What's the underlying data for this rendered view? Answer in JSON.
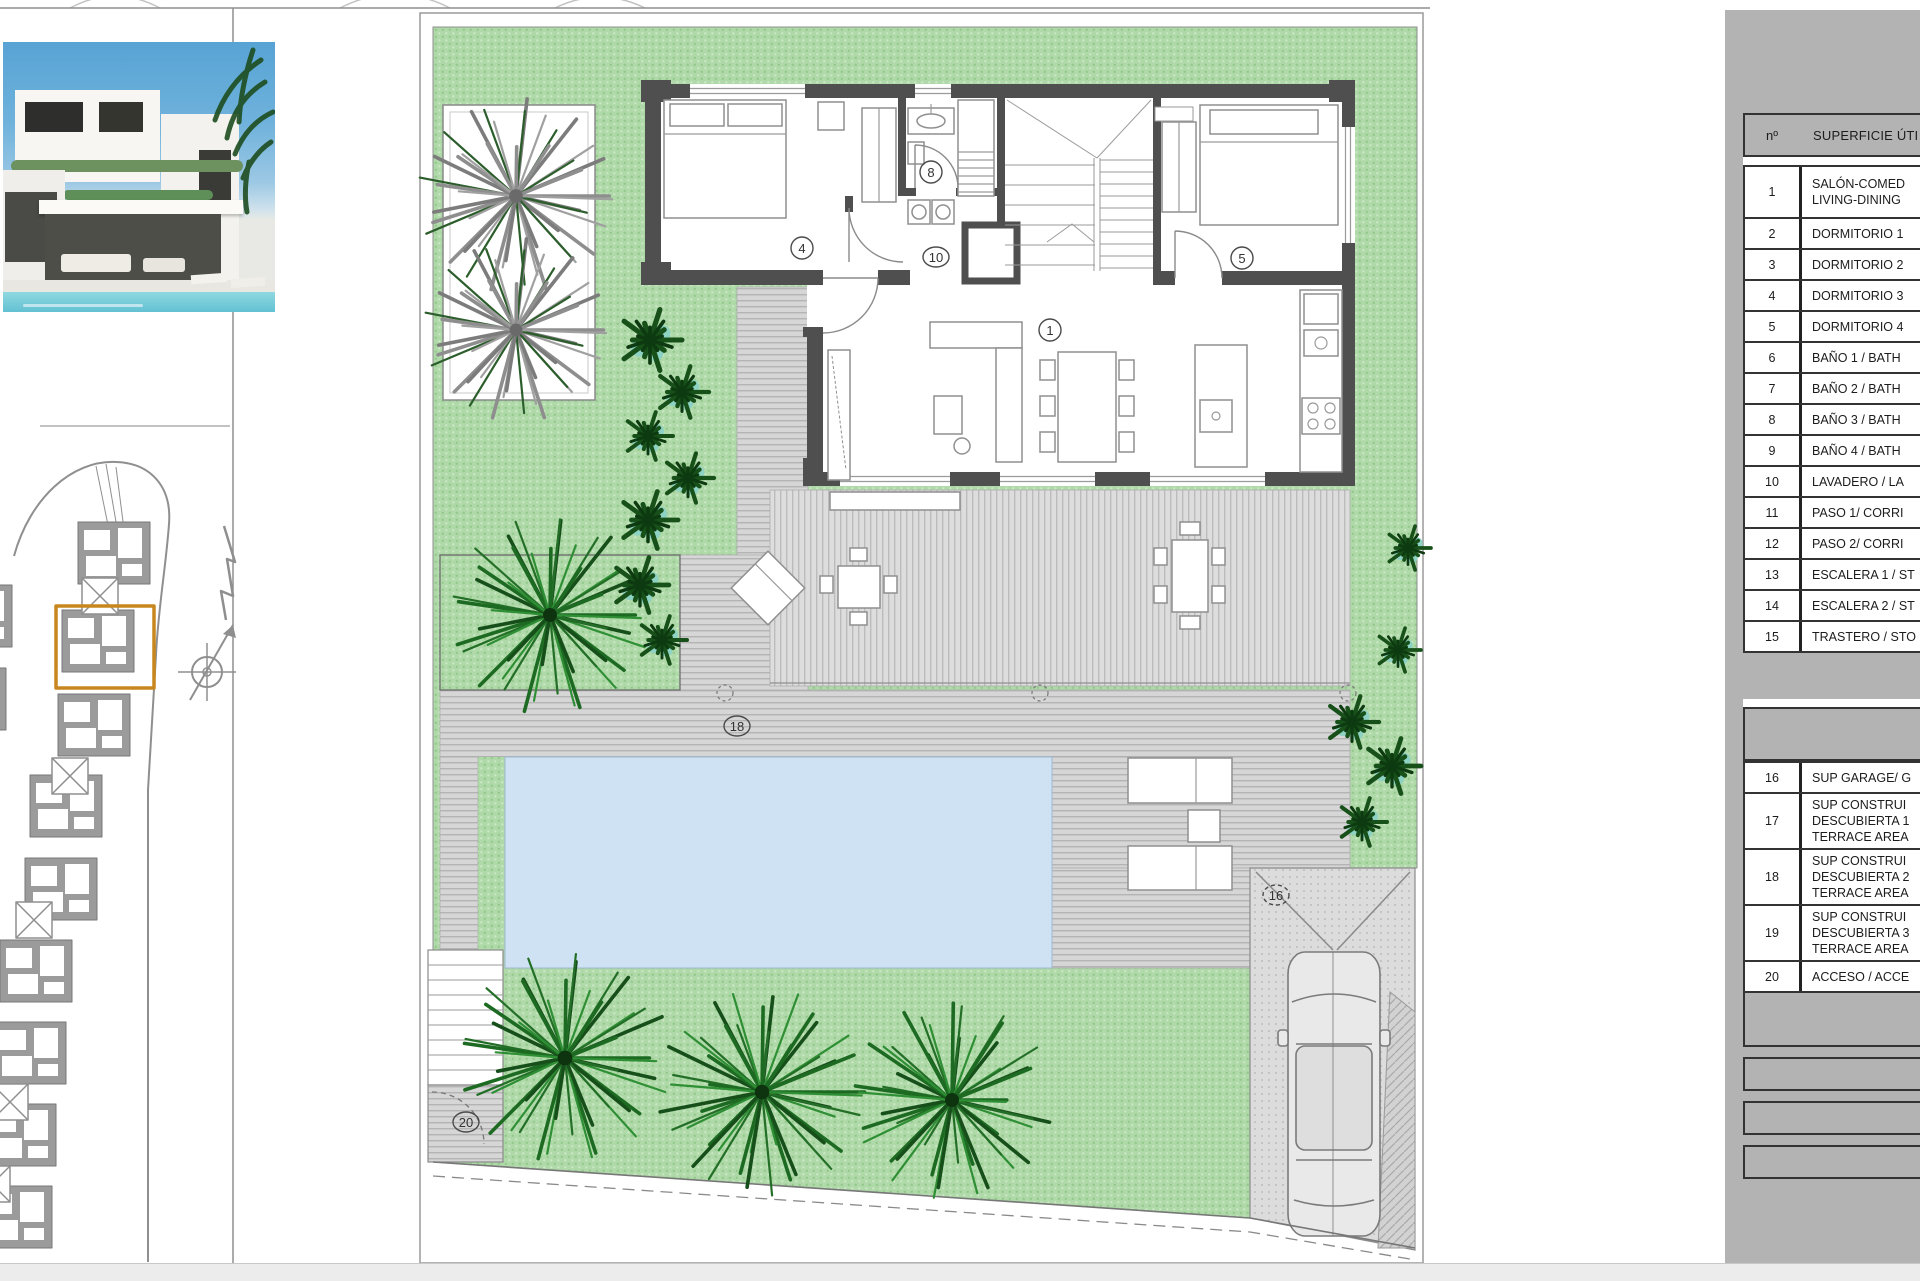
{
  "plan": {
    "labels": [
      {
        "n": "1"
      },
      {
        "n": "4"
      },
      {
        "n": "5"
      },
      {
        "n": "8"
      },
      {
        "n": "10"
      },
      {
        "n": "16"
      },
      {
        "n": "18"
      },
      {
        "n": "20"
      }
    ]
  },
  "table": {
    "header": {
      "no": "nº",
      "desc": "SUPERFICIE ÚTI"
    },
    "rows_useful": [
      {
        "no": "1",
        "l1": "SALÓN-COMED",
        "l2": "LIVING-DINING"
      },
      {
        "no": "2",
        "l1": "DORMITORIO 1"
      },
      {
        "no": "3",
        "l1": "DORMITORIO 2"
      },
      {
        "no": "4",
        "l1": "DORMITORIO 3"
      },
      {
        "no": "5",
        "l1": "DORMITORIO 4"
      },
      {
        "no": "6",
        "l1": "BAÑO 1 / BATH"
      },
      {
        "no": "7",
        "l1": "BAÑO 2 / BATH"
      },
      {
        "no": "8",
        "l1": "BAÑO 3 / BATH"
      },
      {
        "no": "9",
        "l1": "BAÑO 4 / BATH"
      },
      {
        "no": "10",
        "l1": "LAVADERO / LA"
      },
      {
        "no": "11",
        "l1": "PASO 1/ CORRI"
      },
      {
        "no": "12",
        "l1": "PASO 2/ CORRI"
      },
      {
        "no": "13",
        "l1": "ESCALERA 1 / ST"
      },
      {
        "no": "14",
        "l1": "ESCALERA 2 / ST"
      },
      {
        "no": "15",
        "l1": "TRASTERO / STO"
      }
    ],
    "section_built": {
      "l1": "SUP CONSTRUIDA IN",
      "l2": "INTERIOR A"
    },
    "rows_built": [
      {
        "no": "16",
        "l1": "SUP GARAGE/ G"
      },
      {
        "no": "17",
        "l1": "SUP CONSTRUI",
        "l2": "DESCUBIERTA 1",
        "l3": "TERRACE AREA"
      },
      {
        "no": "18",
        "l1": "SUP CONSTRUI",
        "l2": "DESCUBIERTA 2",
        "l3": "TERRACE AREA"
      },
      {
        "no": "19",
        "l1": "SUP CONSTRUI",
        "l2": "DESCUBIERTA 3",
        "l3": "TERRACE AREA"
      },
      {
        "no": "20",
        "l1": "ACCESO / ACCE"
      }
    ],
    "total": {
      "l1": "TOTAL SUP CONSTRUIDA",
      "l2": "BUILT PRIVATE"
    },
    "summary": [
      {
        "label": "PISCINA / SWIMM"
      },
      {
        "label": "SUP. JARDÍN / GAR"
      },
      {
        "label": "SUPERFICE PARCELA"
      }
    ]
  },
  "colors": {
    "highlight_orange": "#c8871e",
    "garden_green": "#afd9a8",
    "pool_blue": "#cfe2f3",
    "wall_gray": "#4f4f4f",
    "panel_gray": "#b3b3b3"
  }
}
